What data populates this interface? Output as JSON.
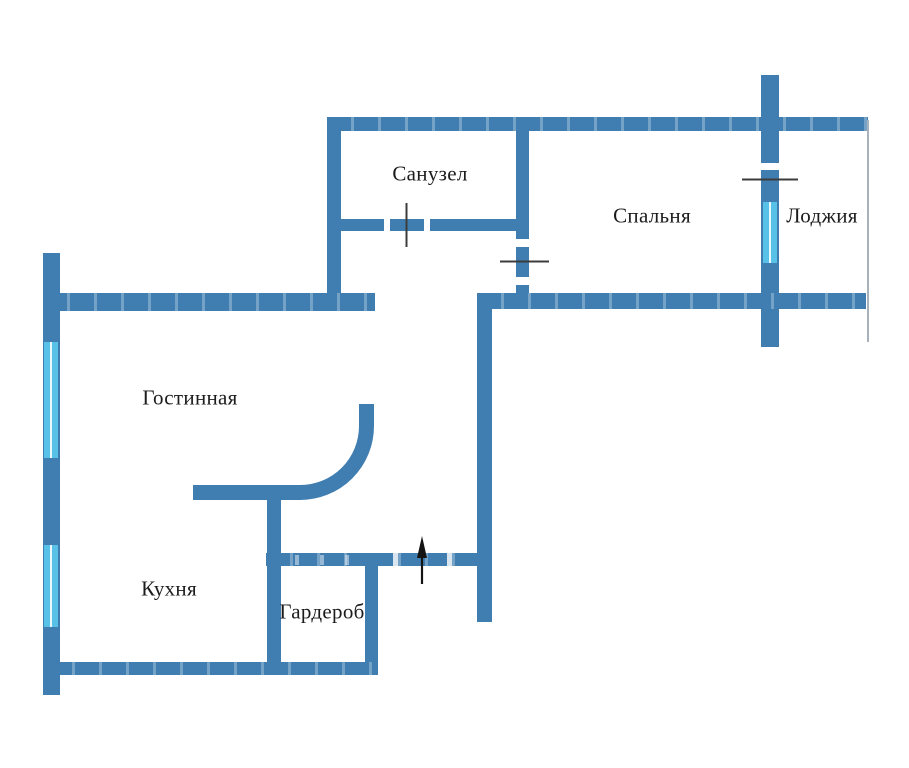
{
  "plan": {
    "rooms": [
      {
        "key": "bathroom",
        "label": "Санузел"
      },
      {
        "key": "bedroom",
        "label": "Спальня"
      },
      {
        "key": "loggia",
        "label": "Лоджия"
      },
      {
        "key": "living",
        "label": "Гостинная"
      },
      {
        "key": "kitchen",
        "label": "Кухня"
      },
      {
        "key": "wardrobe",
        "label": "Гардероб"
      }
    ]
  },
  "colors": {
    "wall": "#407EB1",
    "window": "#57C1E8",
    "window_pane_line": "#EAF8FE",
    "door_tick": "#3C3C3C",
    "arrow": "#141414",
    "loggia_glazing": "#A7B2BD",
    "background": "#FFFFFF",
    "label_text": "#1C1C1C"
  }
}
